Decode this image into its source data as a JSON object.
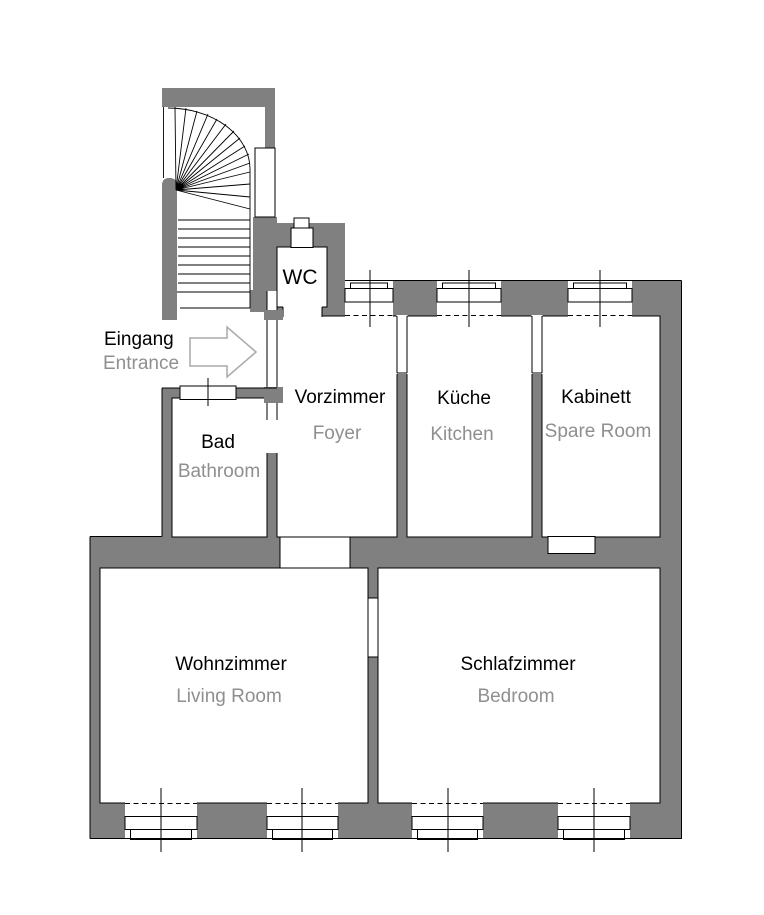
{
  "plan": {
    "colors": {
      "background": "#ffffff",
      "wall": "#808080",
      "outline": "#000000",
      "text_primary": "#000000",
      "text_secondary": "#8f8f8f",
      "arrow_outline": "#a9a9a9"
    },
    "entrance": {
      "de": "Eingang",
      "en": "Entrance"
    },
    "rooms": [
      {
        "id": "wc",
        "de": "WC",
        "en": ""
      },
      {
        "id": "bad",
        "de": "Bad",
        "en": "Bathroom"
      },
      {
        "id": "vorzimmer",
        "de": "Vorzimmer",
        "en": "Foyer"
      },
      {
        "id": "kueche",
        "de": "Küche",
        "en": "Kitchen"
      },
      {
        "id": "kabinett",
        "de": "Kabinett",
        "en": "Spare Room"
      },
      {
        "id": "wohnzimmer",
        "de": "Wohnzimmer",
        "en": "Living Room"
      },
      {
        "id": "schlafzimmer",
        "de": "Schlafzimmer",
        "en": "Bedroom"
      }
    ]
  }
}
